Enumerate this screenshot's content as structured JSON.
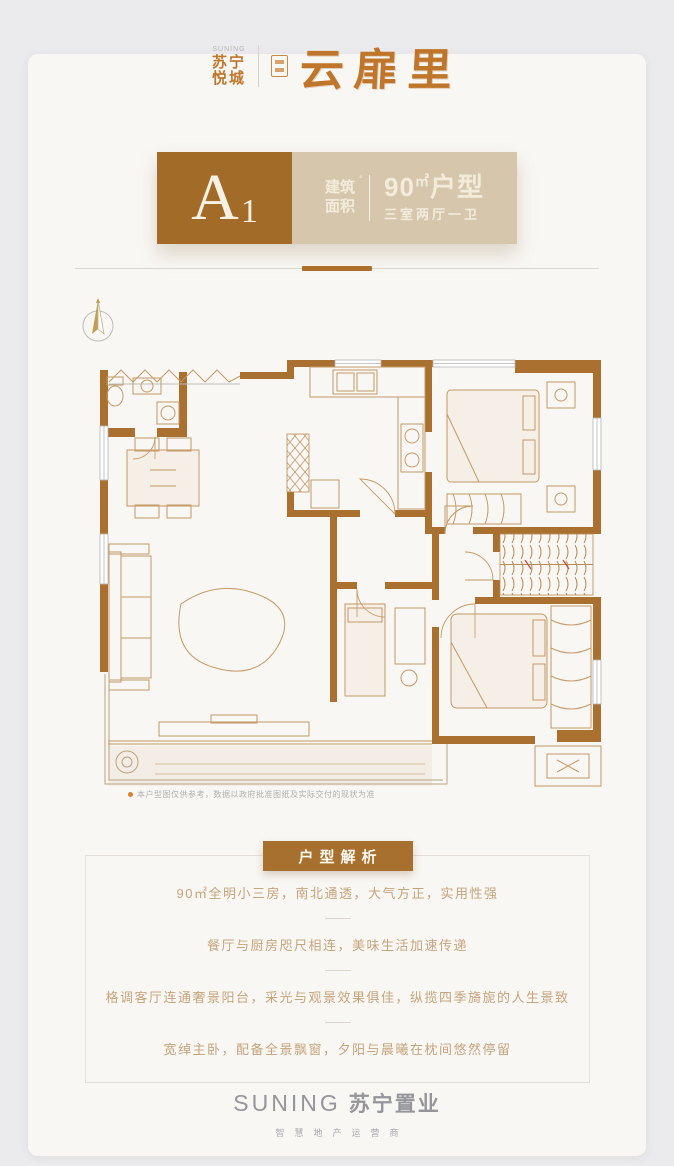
{
  "colors": {
    "page_bg": "#ebebee",
    "card_bg": "#f9f7f4",
    "brand_orange": "#bf752a",
    "header_brown": "#a26b28",
    "header_beige": "#d6c6ab",
    "banner_brown": "#a8702f",
    "wall_brown": "#a9702f",
    "plan_line": "#c49a66",
    "analysis_text": "#c6a47c",
    "footer_gray": "#95959a"
  },
  "brand": {
    "small_top": "SUNING",
    "small_line1": "苏宁",
    "small_line2": "悦城",
    "main": "云扉里"
  },
  "header": {
    "unit_letter": "A",
    "unit_number": "1",
    "area_label_top": "建筑",
    "area_label_bottom": "面积",
    "area_number": "90",
    "area_unit": "㎡",
    "area_word": "户型",
    "rooms_desc": "三室两厅一卫"
  },
  "plan": {
    "note": "本户型图仅供参考，数据以政府批准图纸及实际交付的现状为准"
  },
  "analysis": {
    "title": "户型解析",
    "items": [
      "90㎡全明小三房，南北通透，大气方正，实用性强",
      "餐厅与厨房咫尺相连，美味生活加速传递",
      "格调客厅连通奢景阳台，采光与观景效果俱佳，纵揽四季旖旎的人生景致",
      "宽绰主卧，配备全景飘窗，夕阳与晨曦在枕间悠然停留"
    ]
  },
  "footer": {
    "logo_en": "SUNING",
    "logo_cn": "苏宁置业",
    "tagline": "智慧地产运营商"
  }
}
